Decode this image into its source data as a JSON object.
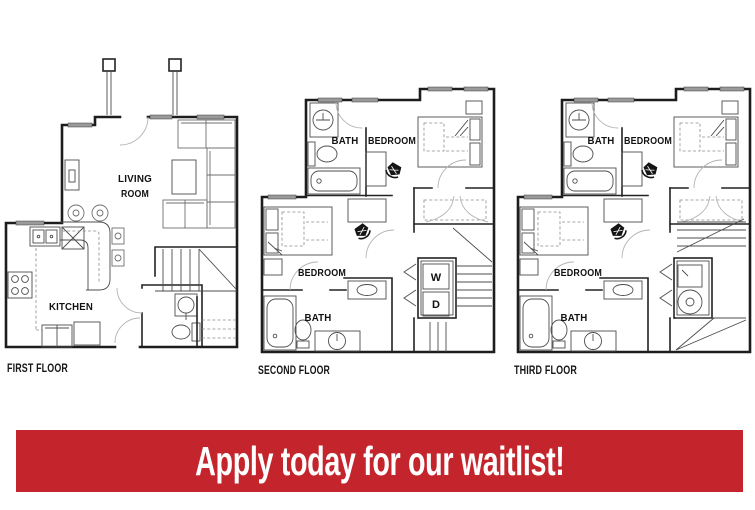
{
  "banner": {
    "label": "Apply today for our waitlist!",
    "bg_color": "#C4242B",
    "text_color": "#FFFFFF"
  },
  "floors": [
    {
      "name": "first-floor",
      "label": "FIRST FLOOR",
      "rooms": {
        "living_1": "LIVING",
        "living_2": "ROOM",
        "kitchen": "KITCHEN"
      }
    },
    {
      "name": "second-floor",
      "label": "SECOND FLOOR",
      "rooms": {
        "bath_upper": "BATH",
        "bedroom_upper": "BEDROOM",
        "bedroom_lower": "BEDROOM",
        "bath_lower": "BATH",
        "washer": "W",
        "dryer": "D"
      }
    },
    {
      "name": "third-floor",
      "label": "THIRD FLOOR",
      "rooms": {
        "bath_upper": "BATH",
        "bedroom_upper": "BEDROOM",
        "bedroom_lower": "BEDROOM",
        "bath_lower": "BATH"
      }
    }
  ],
  "colors": {
    "wall": "#1D1D1B",
    "furniture": "#6F6F6F",
    "window": "#9A9A9A",
    "accent_red": "#C4242B"
  }
}
